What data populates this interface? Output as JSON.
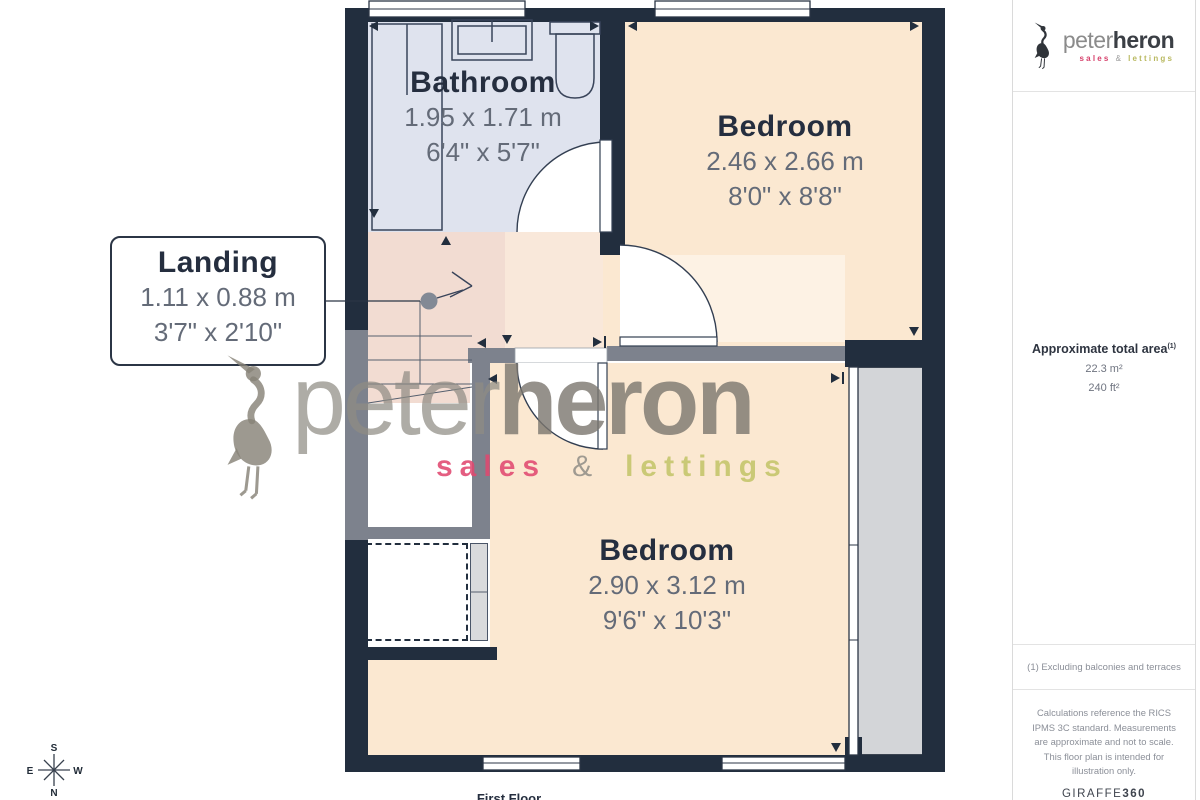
{
  "colors": {
    "wall": "#222e3e",
    "wall_gray": "#7d828d",
    "floor_bathroom": "#dfe3ee",
    "floor_bedroom": "#fbe8d1",
    "floor_hall": "#f9e8da",
    "floor_landing": "#f2dcd2",
    "exterior_gray": "#d3d5d8",
    "label": "#252e3f",
    "dims": "#646b78",
    "sales_pink": "#d6406b",
    "lettings_olive": "#b9b960",
    "watermark_gray": "#827d74"
  },
  "plan": {
    "floor_label": "First Floor",
    "rooms": {
      "bathroom": {
        "name": "Bathroom",
        "metric": "1.95 x 1.71 m",
        "imperial": "6'4\" x 5'7\""
      },
      "bedroom1": {
        "name": "Bedroom",
        "metric": "2.46 x 2.66 m",
        "imperial": "8'0\" x 8'8\""
      },
      "landing": {
        "name": "Landing",
        "metric": "1.11 x 0.88 m",
        "imperial": "3'7\" x 2'10\""
      },
      "bedroom2": {
        "name": "Bedroom",
        "metric": "2.90 x 3.12 m",
        "imperial": "9'6\" x 10'3\""
      }
    },
    "compass": {
      "north": "N",
      "south": "S",
      "east": "E",
      "west": "W"
    }
  },
  "watermark": {
    "brand_primary": "peter",
    "brand_secondary": "heron",
    "sales": "sales",
    "ampersand": "&",
    "lettings": "lettings"
  },
  "sidebar": {
    "logo": {
      "brand_primary": "peter",
      "brand_secondary": "heron",
      "sales": "sales",
      "ampersand": "&",
      "lettings": "lettings"
    },
    "area": {
      "title": "Approximate total area",
      "footnote_ref": "(1)",
      "metric": "22.3 m²",
      "imperial": "240 ft²"
    },
    "footnote": "(1) Excluding balconies and terraces",
    "disclaimer": "Calculations reference the RICS IPMS 3C standard. Measurements are approximate and not to scale. This floor plan is intended for illustration only.",
    "credit": {
      "brand": "GIRAFFE",
      "suffix": "360"
    }
  }
}
